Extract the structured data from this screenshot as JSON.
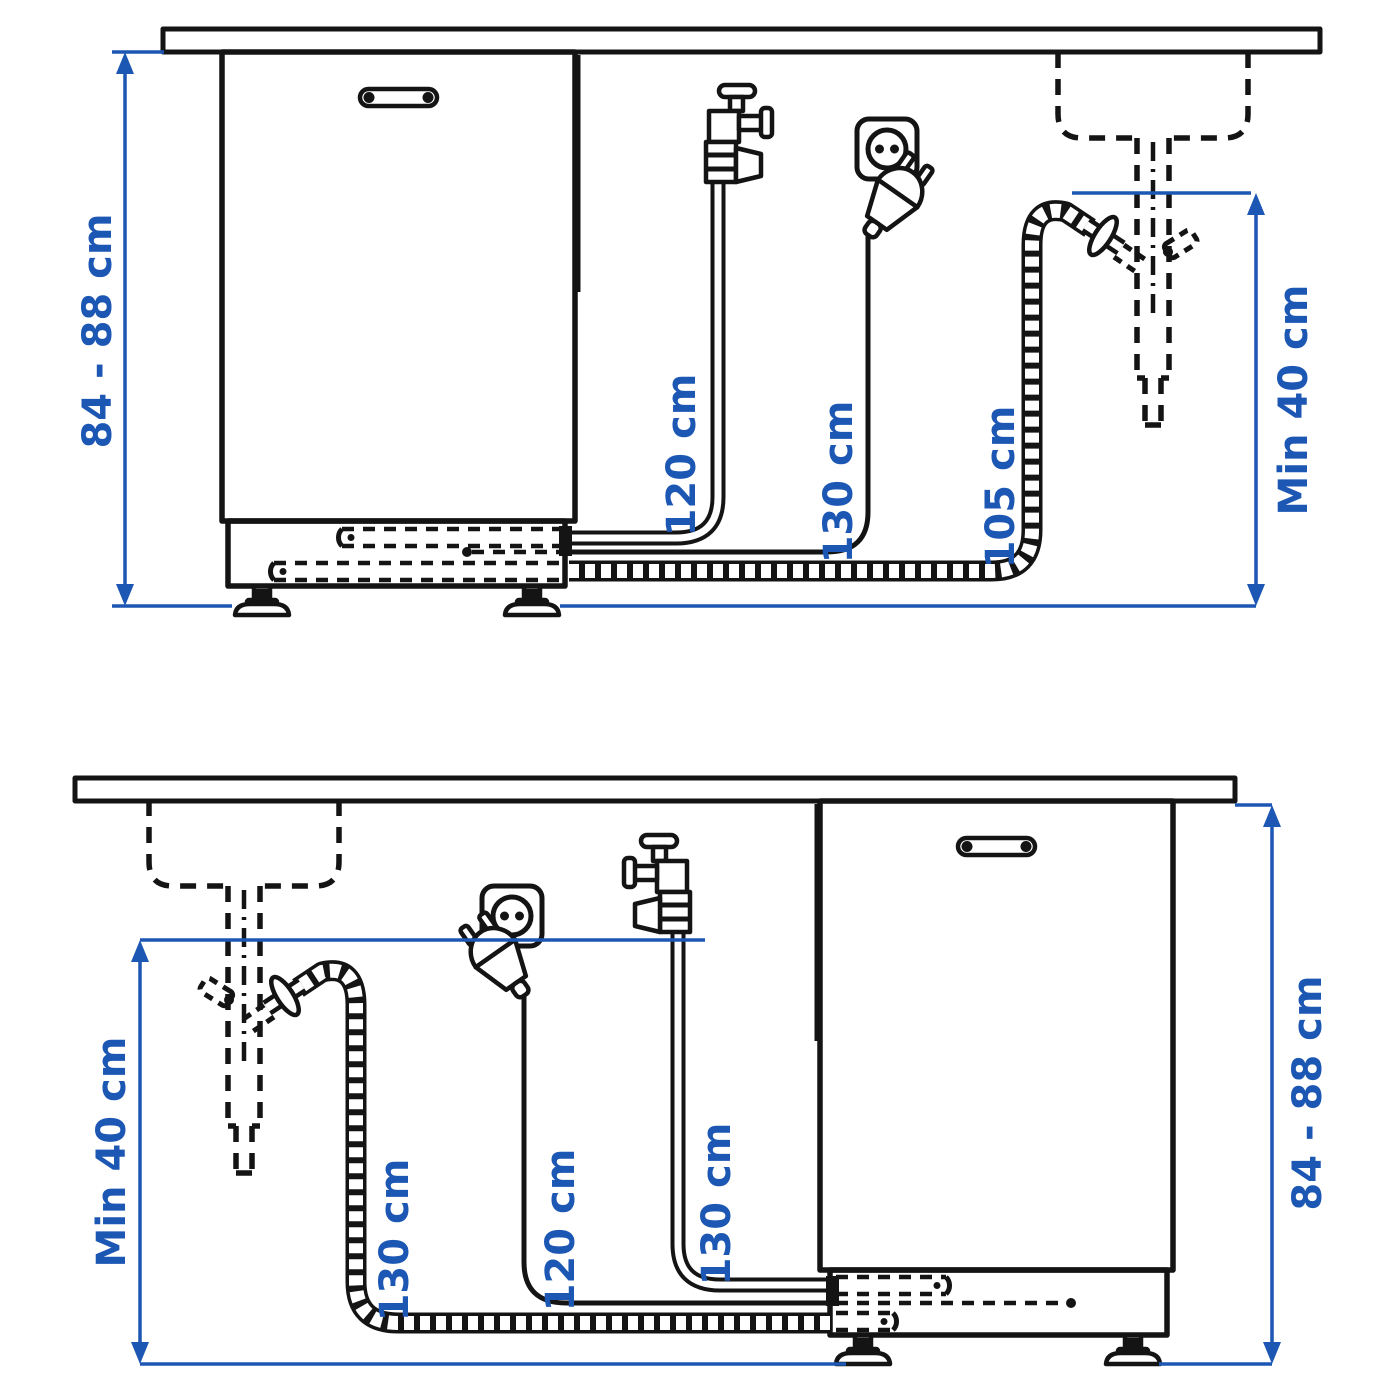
{
  "title": "Dishwasher installation clearances diagram",
  "colors": {
    "dimension_blue": "#1d57b4",
    "line_black": "#141414",
    "background": "#ffffff"
  },
  "diagrams": {
    "top": {
      "name": "connections-right-of-dishwasher",
      "height_label": "84 - 88 cm",
      "supply_hose_label": "120 cm",
      "power_cable_label": "130 cm",
      "drain_hose_label": "105 cm",
      "drain_height_label": "Min 40 cm"
    },
    "bottom": {
      "name": "connections-left-of-dishwasher",
      "drain_height_label": "Min 40 cm",
      "drain_hose_label": "130 cm",
      "power_cable_label": "120 cm",
      "supply_hose_label": "130 cm",
      "height_label": "84 - 88 cm"
    }
  }
}
